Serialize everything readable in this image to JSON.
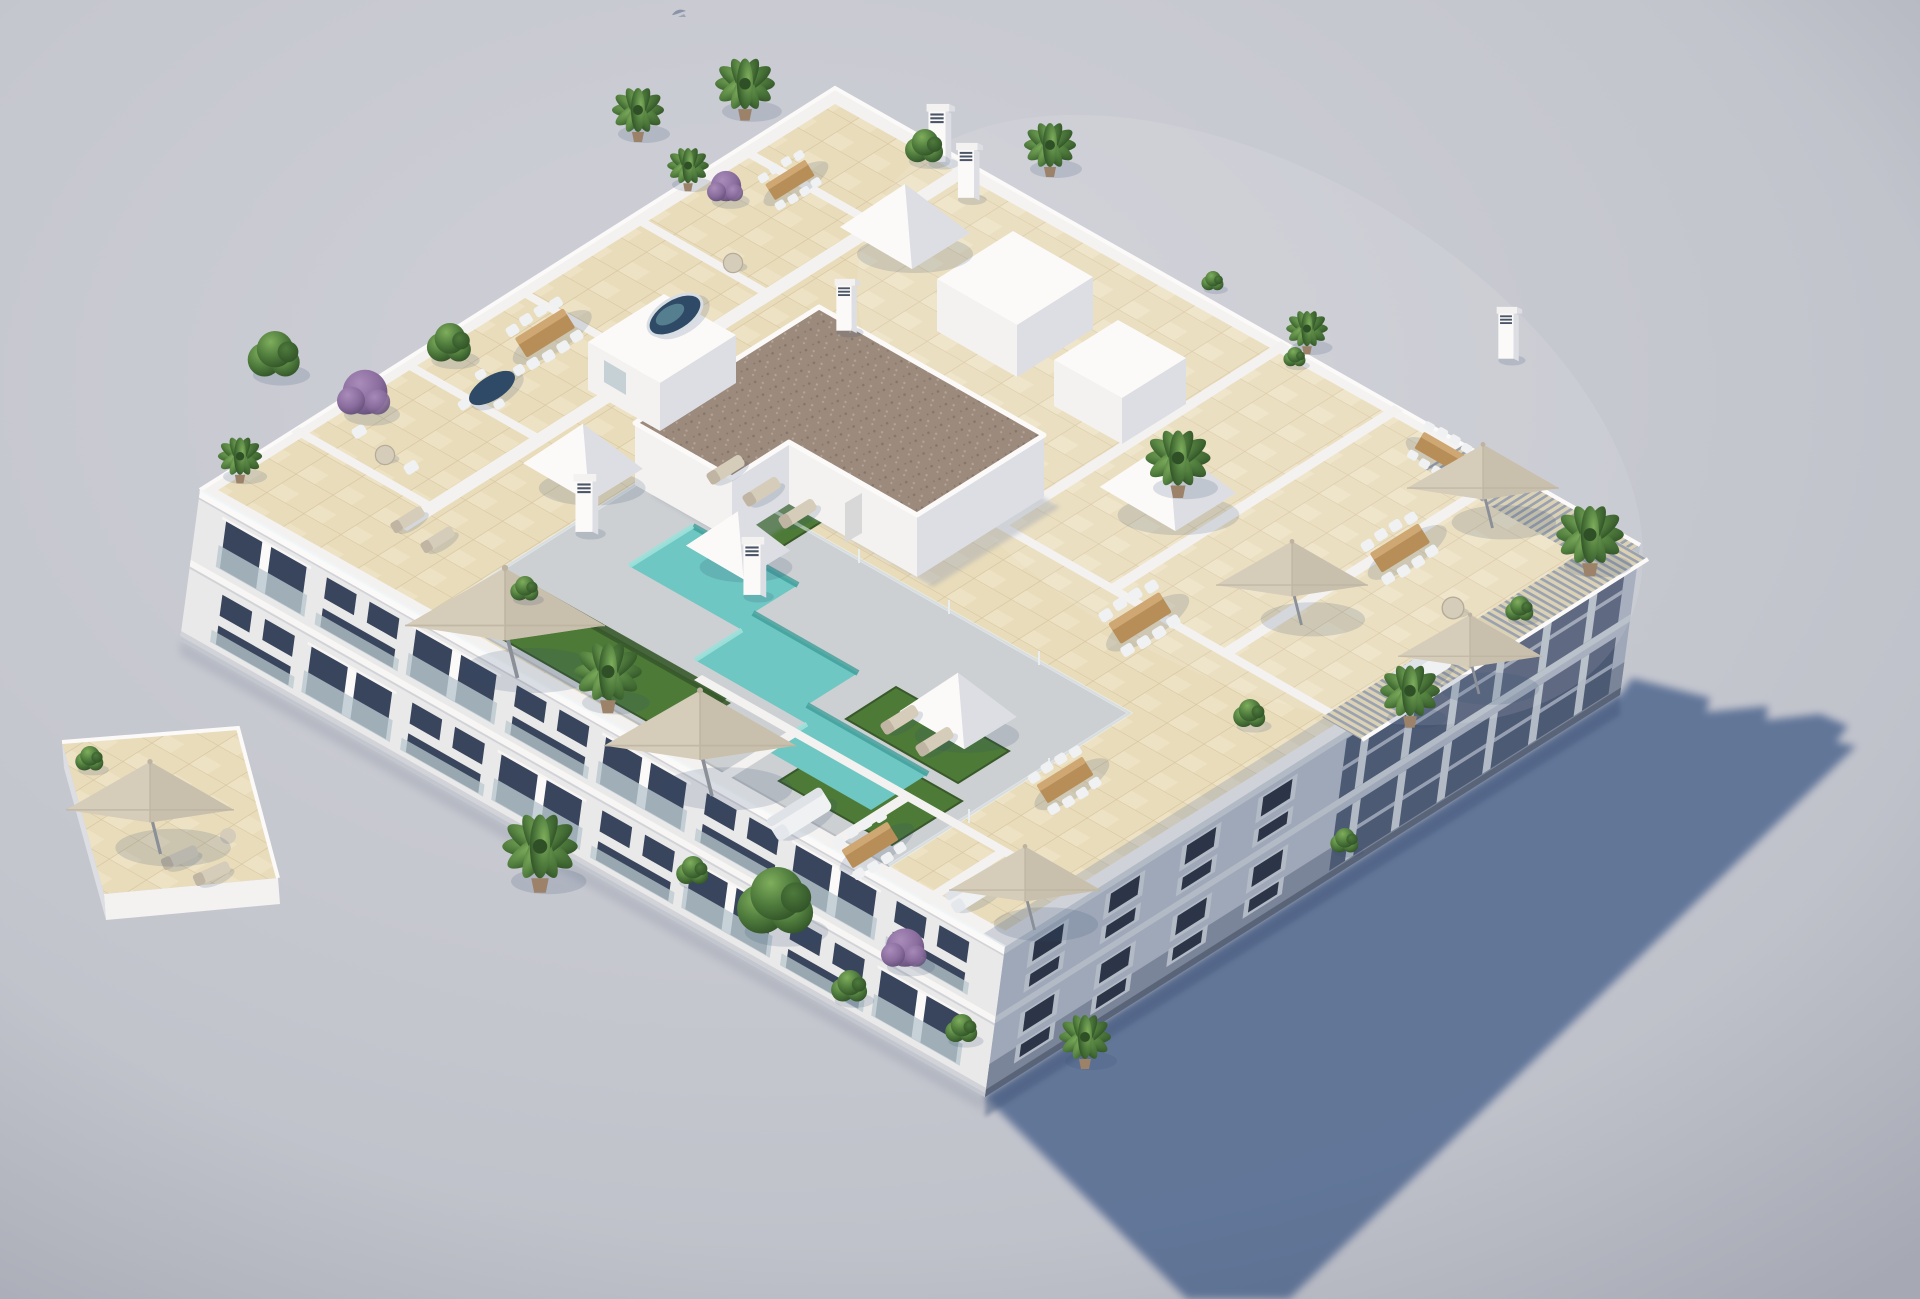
{
  "scene": {
    "description": "Aerial three-quarter 3D architectural rendering of a white modern apartment block with a landscaped rooftop: turquoise stepped swimming pool with grey deck and glass fence, artificial grass patches, beige tiled private terraces divided by white parapet walls, cream parasols, wooden dining sets with white chairs, white lounge sofas, potted palms, green and purple shrubs, five white pyramid skylights, a brown gravel-roofed stair core, slatted pergolas on the east corner, and a long blue-grey shadow cast to the lower right on a plain grey studio background.",
    "background": "plain light grey-lavender studio backdrop",
    "light_direction": "upper-left",
    "visible_text": "none",
    "bird_count": 1
  },
  "palette": {
    "bg1": "#cfd0d7",
    "bg2": "#c4c6ce",
    "bg3": "#b8bac4",
    "shadow": "#5a6f94",
    "shadowContact": "#44587b",
    "aoBlue": "#8d97ab",
    "wallWhite": "#f3f2f0",
    "wallBright": "#fbfaf9",
    "wallShade": "#dcdee3",
    "wallDark": "#c2c6cf",
    "facadeSW": "#eae9e9",
    "facadeSWLight": "#f7f6f4",
    "facadeSWShade": "#d2d3d8",
    "facadeSE": "#9fa8b8",
    "facadeSELight": "#b2bac6",
    "facadeSEDark": "#7b8599",
    "facadeSEDarker": "#5a6479",
    "loggia": "#4d5a74",
    "window": "#39455c",
    "windowDark": "#2c3547",
    "glass": "#b9c8ce",
    "tile": "#e9dcba",
    "tileLine": "#d6c5a0",
    "tileBright": "#f6eed6",
    "deck": "#cdd0d2",
    "deckShade": "#b9bdc1",
    "pool": "#6ec7c2",
    "poolLight": "#9fe0da",
    "poolDark": "#3f9e9a",
    "grass": "#4d7a37",
    "grassDark": "#39592b",
    "gravel": "#9c8a7c",
    "gravelDark": "#84756a",
    "gravelLight": "#b3a396",
    "wood": "#b78e58",
    "woodLight": "#d2ac78",
    "fabric": "#d5ccba",
    "fabricShade": "#c0b5a2",
    "whiteFurn": "#eff1f3",
    "cushion": "#dfe3e7",
    "pot": "#9b8268",
    "foliageLight": "#7fae5c",
    "foliage": "#4e7a3c",
    "foliageDark": "#2f5026",
    "purpleLight": "#a98cba",
    "purple": "#8a6d9d",
    "purpleDark": "#64507a",
    "pergola": "#dbd2b6",
    "pergolaGap": "#9aa1af",
    "tableBlue": "#2e4a66",
    "bird": "#8b93a8",
    "pole": "#8a8f98"
  },
  "building": {
    "style": "modern Mediterranean apartment block",
    "material": "white render",
    "floors_visible": 3,
    "visible_facades": [
      "southwest facade, sunlit, with recessed balconies, glass balustrades and dark glazing",
      "southeast facade, in shade, with small windows near the corner and column loggias under pergolas"
    ]
  },
  "rooftop": {
    "floor": "beige ceramic tile grid",
    "pool": {
      "color": "turquoise",
      "shape": "stepped zig-zag",
      "deck": "grey stone",
      "fence": "glass with posts"
    },
    "skylight_pyramids": 5,
    "stair_core": {
      "roof": "brown gravel",
      "walls": "white",
      "doors": 1
    },
    "roof_access_boxes": 3,
    "chimneys": 6,
    "pergolas": 2,
    "parasols": 7,
    "dining_sets": 7,
    "sun_loungers": 9,
    "sofas": 3,
    "round_tables": 3,
    "spa_tub": 1,
    "dark_oval_table": 1,
    "plants": {
      "palms": 12,
      "green_bushes": 12,
      "purple_shrubs": 3,
      "olive_tree": 1
    }
  }
}
